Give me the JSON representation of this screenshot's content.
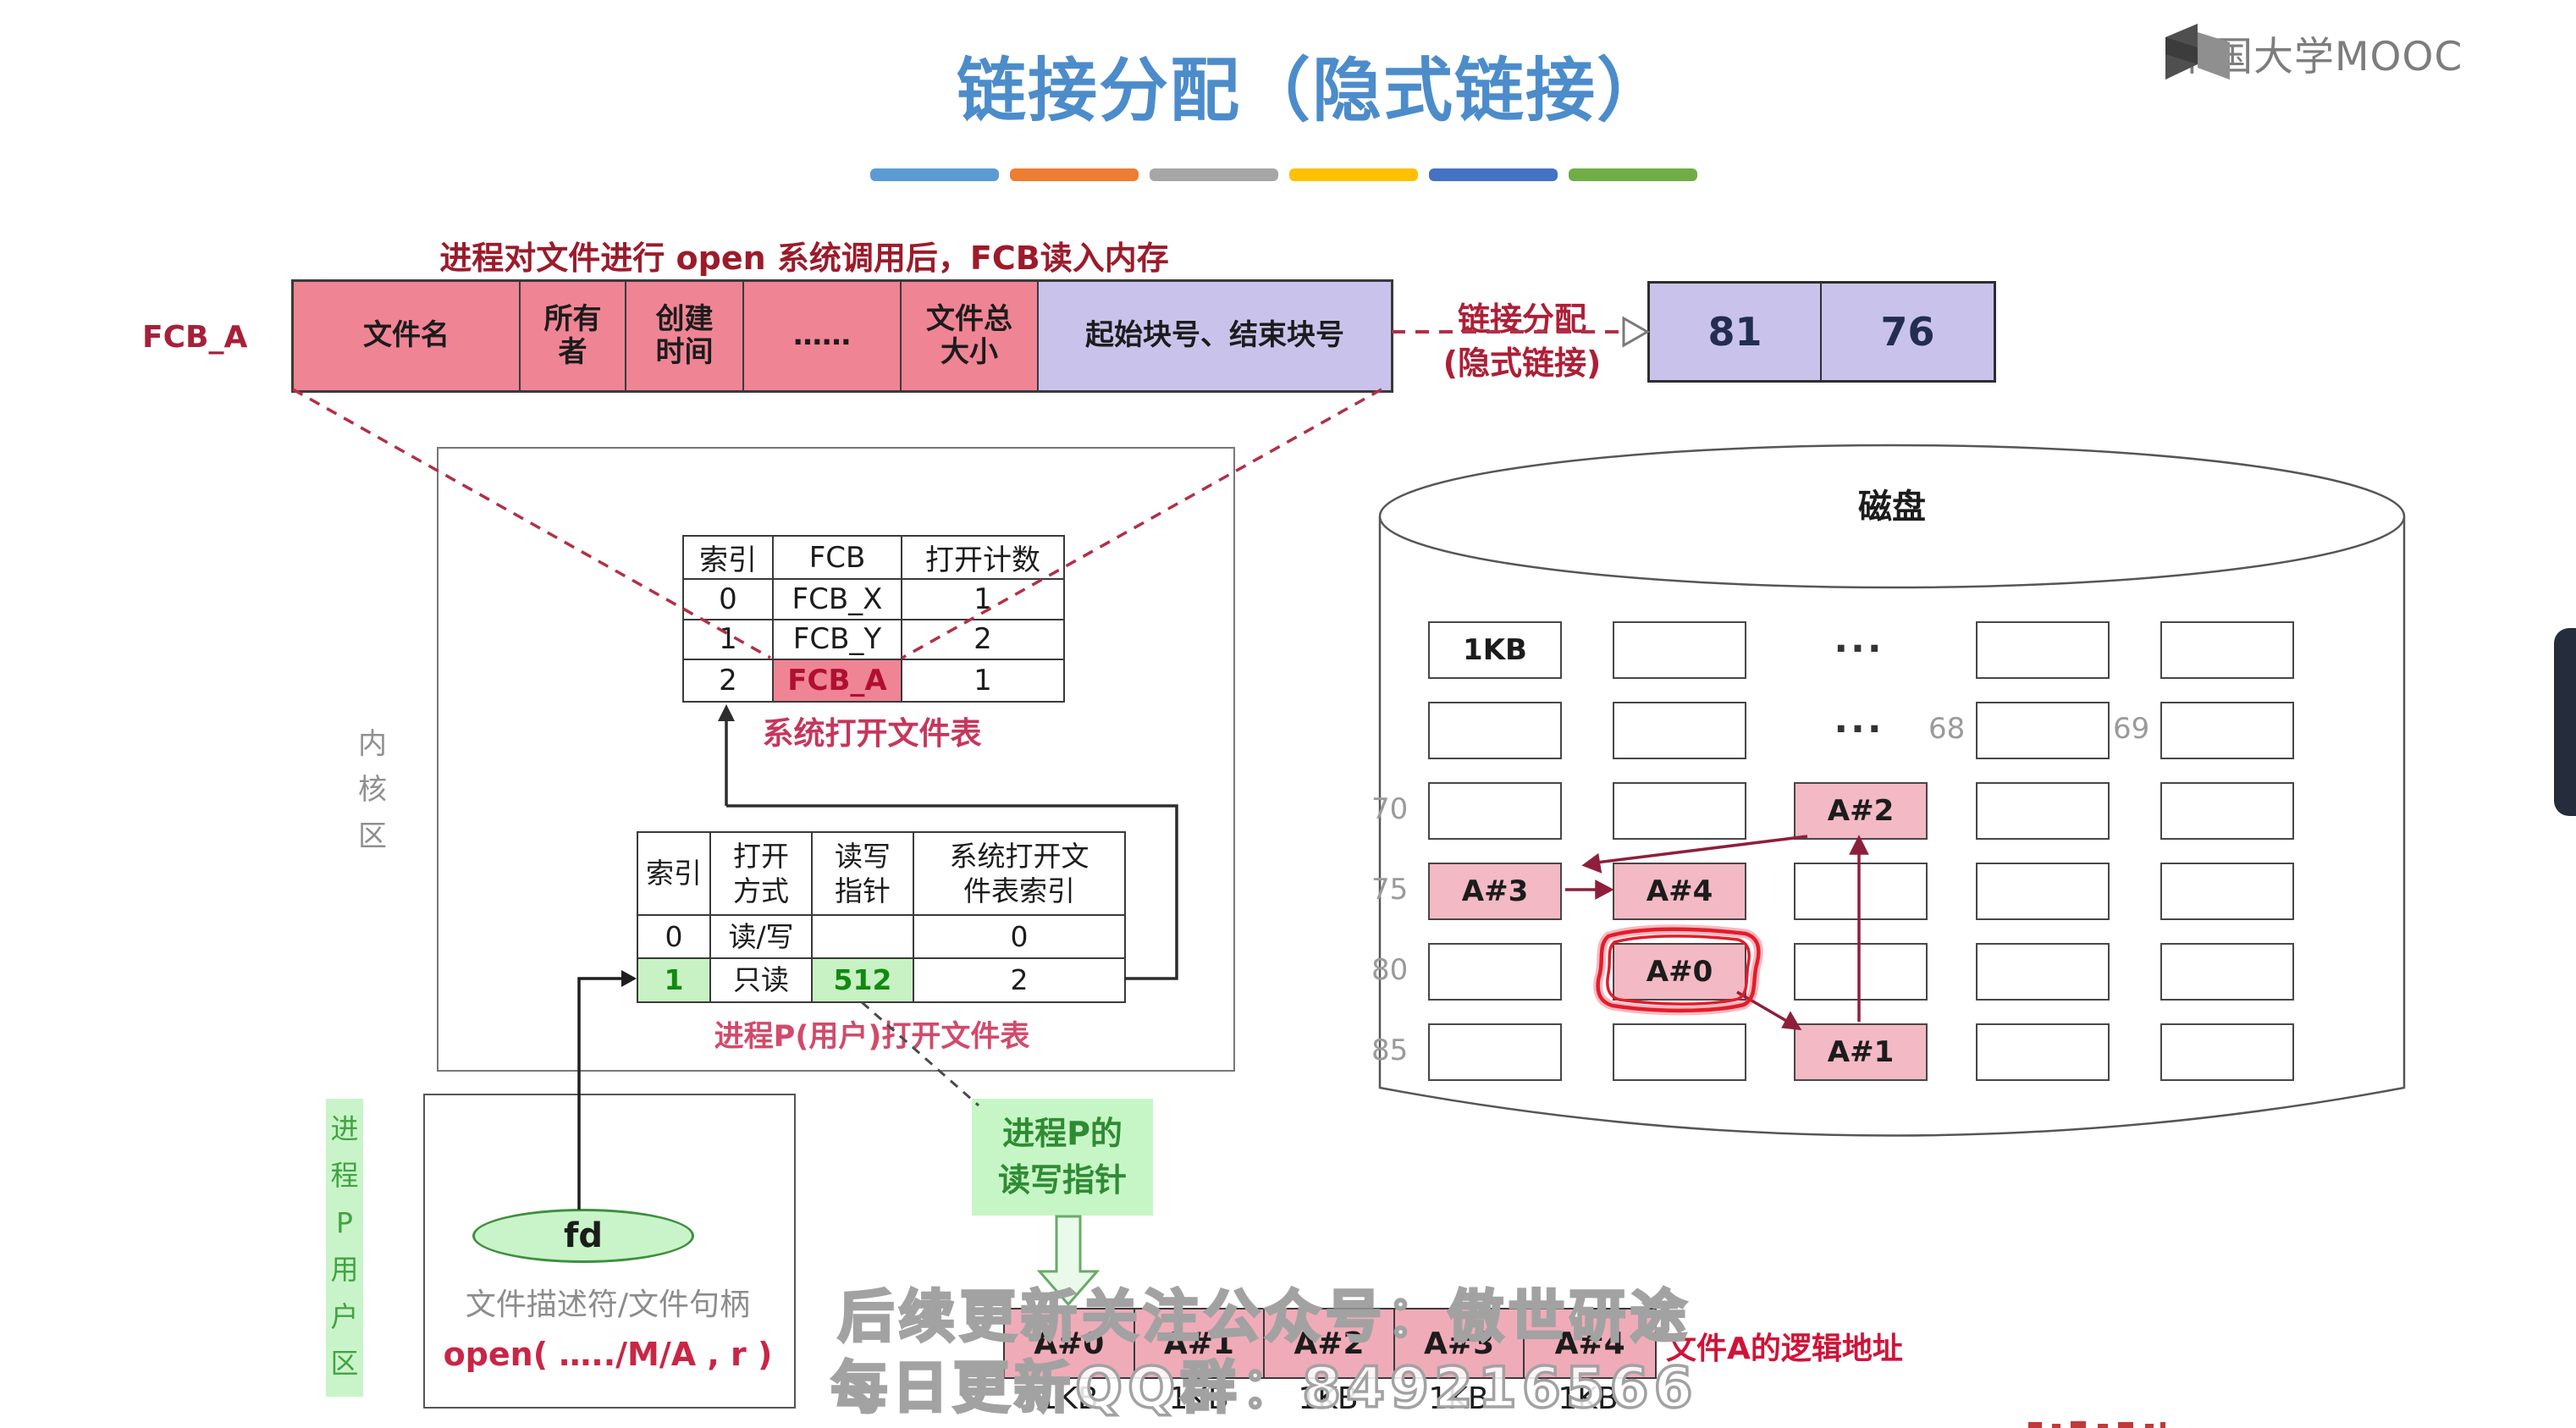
{
  "brand": {
    "name": "中国大学MOOC"
  },
  "title": "链接分配（隐式链接）",
  "accent_colors": [
    "#5b9bd5",
    "#ed7d31",
    "#a6a6a6",
    "#ffc000",
    "#4472c4",
    "#70ad47"
  ],
  "fcb": {
    "caption": "进程对文件进行 open 系统调用后，FCB读入内存",
    "label": "FCB_A",
    "cells": [
      "文件名",
      "所有\n者",
      "创建\n时间",
      "……",
      "文件总\n大小"
    ],
    "link_cell": "起始块号、结束块号"
  },
  "link_alloc": {
    "line1": "链接分配",
    "line2": "(隐式链接)",
    "blocks": [
      "81",
      "76"
    ]
  },
  "kernel": {
    "label": "内\n核\n区",
    "sys_table": {
      "headers": [
        "索引",
        "FCB",
        "打开计数"
      ],
      "rows": [
        [
          "0",
          "FCB_X",
          "1"
        ],
        [
          "1",
          "FCB_Y",
          "2"
        ],
        [
          "2",
          "FCB_A",
          "1"
        ]
      ],
      "caption": "系统打开文件表"
    },
    "proc_table": {
      "headers": [
        "索引",
        "打开\n方式",
        "读写\n指针",
        "系统打开文\n件表索引"
      ],
      "rows": [
        [
          "0",
          "读/写",
          "",
          "0"
        ],
        [
          "1",
          "只读",
          "512",
          "2"
        ]
      ],
      "caption": "进程P(用户)打开文件表"
    }
  },
  "user_area": {
    "label": "进\n程\nP\n用\n户\n区",
    "fd": "fd",
    "desc": "文件描述符/文件句柄",
    "open_call": "open( …../M/A , r )"
  },
  "rw_pointer": {
    "label": "进程P的\n读写指针"
  },
  "disk": {
    "title": "磁盘",
    "first_block": "1KB",
    "ellipsis": "...",
    "row_labels": {
      "n68": "68",
      "n69": "69",
      "n70": "70",
      "n75": "75",
      "n80": "80",
      "n85": "85"
    },
    "blocks": {
      "a0": "A#0",
      "a1": "A#1",
      "a2": "A#2",
      "a3": "A#3",
      "a4": "A#4"
    }
  },
  "logical": {
    "blocks": [
      "A#0",
      "A#1",
      "A#2",
      "A#3",
      "A#4"
    ],
    "size": "1KB",
    "caption": "文件A的逻辑地址"
  },
  "watermark": {
    "line1": "后续更新关注公众号：傲世研途",
    "line2": "每日更新QQ群：849216566"
  }
}
